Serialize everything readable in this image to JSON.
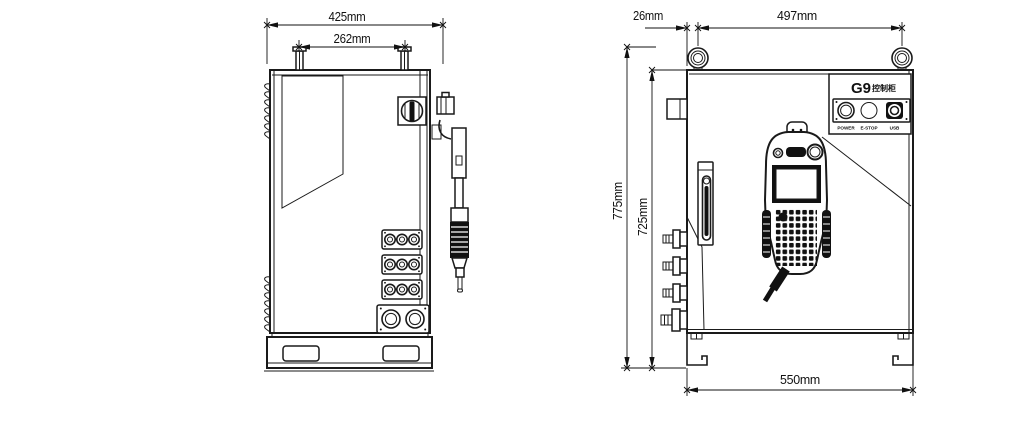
{
  "page": {
    "background": "#ffffff"
  },
  "drawing": {
    "line_color": "#1a1a1a",
    "side_view": {
      "dim_overall_depth": "425mm",
      "dim_eyebolt_spacing": "262mm"
    },
    "front_view": {
      "dim_eyebolt_offset": "26mm",
      "dim_eyebolt_spacing": "497mm",
      "dim_overall_height": "775mm",
      "dim_body_height": "725mm",
      "dim_base_width": "550mm",
      "panel": {
        "model": "G9",
        "model_suffix": "控制柜",
        "label_power": "POWER",
        "label_estop": "E-STOP",
        "label_usb": "USB"
      }
    }
  }
}
